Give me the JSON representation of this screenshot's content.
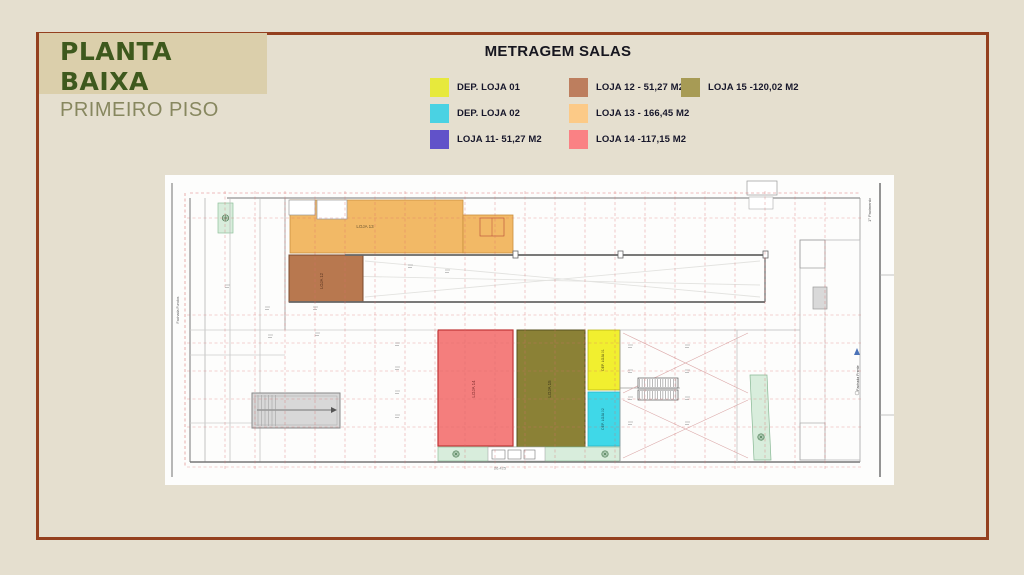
{
  "page": {
    "background": "#e5dfcf",
    "frame_border_color": "#94401f"
  },
  "header": {
    "title": "PLANTA BAIXA",
    "subtitle": "PRIMEIRO PISO",
    "title_color": "#3e591d",
    "subtitle_color": "#87875f",
    "box_background": "#dbcfab"
  },
  "legend": {
    "title": "METRAGEM SALAS",
    "columns": [
      {
        "items": [
          {
            "label": "DEP. LOJA 01",
            "color": "#e7e93c"
          },
          {
            "label": "DEP. LOJA 02",
            "color": "#4ad2e3"
          },
          {
            "label": "LOJA 11- 51,27 M2",
            "color": "#6152c9"
          }
        ]
      },
      {
        "items": [
          {
            "label": "LOJA 12 - 51,27 M2",
            "color": "#bd7e5e"
          },
          {
            "label": "LOJA 13 - 166,45 M2",
            "color": "#fcca87"
          },
          {
            "label": "LOJA 14 -117,15 M2",
            "color": "#fa8184"
          }
        ]
      },
      {
        "items": [
          {
            "label": "LOJA 15 -120,02 M2",
            "color": "#a79b55"
          }
        ]
      }
    ]
  },
  "plan": {
    "region_colors": {
      "loja13": "#f2b966",
      "loja12": "#b8784f",
      "loja14": "#f47e7d",
      "loja15": "#8b8136",
      "dep01": "#f1ef2f",
      "dep02": "#3fd8e8",
      "landscape": "#d8eddc",
      "ramp": "#d8d8d8"
    },
    "room_labels": {
      "loja13": "LOJA 13",
      "loja12": "LOJA 12",
      "loja14": "LOJA 14",
      "loja15": "LOJA 15",
      "dep01": "DEP. LOJA 01",
      "dep02": "DEP. LOJA 02"
    },
    "annotations": {
      "right_top": "1° Pavimento",
      "right_mid": "Fachada Frente",
      "left_mid": "Fachada Fundos",
      "bottom_dim": "26.425"
    }
  }
}
